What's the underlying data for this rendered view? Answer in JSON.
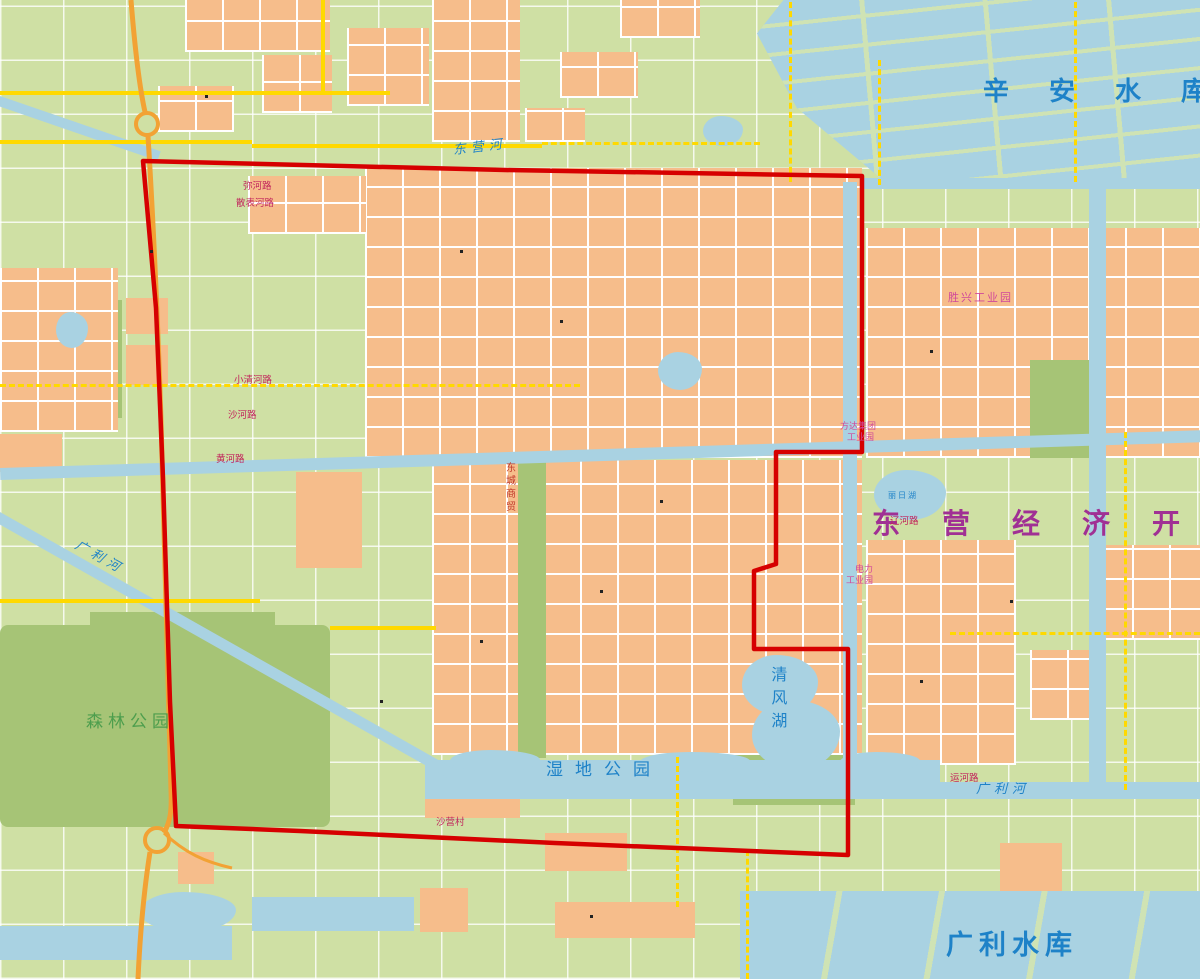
{
  "map": {
    "palette": {
      "land": "#cfe0a4",
      "park_green": "#a6c476",
      "water_blue": "#a9d2e2",
      "urban_orange": "#f6bd8b",
      "road_yellow": "#ffd900",
      "expressway_orange": "#f2a234",
      "boundary_red": "#d60000",
      "water_text": "#1e82c8",
      "city_text": "#a03094",
      "road_text": "#c2255c",
      "park_text": "#4d9e4d"
    },
    "labels": [
      {
        "name": "xinan-reservoir-label",
        "text": "辛安水库",
        "x": 983,
        "y": 78,
        "cls": "lbl-water-lg"
      },
      {
        "name": "guangli-reservoir-label",
        "text": "广利水库",
        "x": 946,
        "y": 930,
        "cls": "lbl-water-res"
      },
      {
        "name": "dev-zone-label",
        "text": "东营经济开",
        "x": 872,
        "y": 508,
        "cls": "lbl-city"
      },
      {
        "name": "forest-park-label",
        "text": "森林公园",
        "x": 86,
        "y": 713,
        "cls": "lbl-park"
      },
      {
        "name": "wetland-park-label",
        "text": "湿地公园",
        "x": 546,
        "y": 761,
        "cls": "lbl-wetland"
      },
      {
        "name": "qingfeng-lake-label",
        "text": "清风湖",
        "x": 768,
        "y": 666,
        "cls": "lbl-lake-v"
      },
      {
        "name": "liri-lake-label",
        "text": "丽日湖",
        "x": 888,
        "y": 491,
        "cls": "lbl-lake-sm"
      },
      {
        "name": "guangli-river-west-label",
        "text": "广利河",
        "x": 72,
        "y": 551,
        "cls": "lbl-river",
        "rot": 29
      },
      {
        "name": "guangli-river-east-label",
        "text": "广利河",
        "x": 976,
        "y": 783,
        "cls": "lbl-river"
      },
      {
        "name": "dongying-river-label",
        "text": "东营河",
        "x": 453,
        "y": 141,
        "cls": "lbl-river",
        "rot": -7
      },
      {
        "name": "xiaoqinghe-road-label",
        "text": "小清河路",
        "x": 234,
        "y": 376,
        "cls": "lbl-road"
      },
      {
        "name": "shahe-road-label",
        "text": "沙河路",
        "x": 228,
        "y": 411,
        "cls": "lbl-road"
      },
      {
        "name": "huanghe-road-label",
        "text": "黄河路",
        "x": 216,
        "y": 455,
        "cls": "lbl-road"
      },
      {
        "name": "mihe-road-label",
        "text": "弥河路",
        "x": 243,
        "y": 182,
        "cls": "lbl-road"
      },
      {
        "name": "sanbiao-road-label",
        "text": "散表河路",
        "x": 236,
        "y": 199,
        "cls": "lbl-road"
      },
      {
        "name": "shengxing-industrial-label",
        "text": "胜兴工业园",
        "x": 948,
        "y": 292,
        "cls": "lbl-ind"
      },
      {
        "name": "fangda-industrial-label-1",
        "text": "方达集团",
        "x": 840,
        "y": 422,
        "cls": "lbl-ind-sm"
      },
      {
        "name": "fangda-industrial-label-2",
        "text": "工业园",
        "x": 847,
        "y": 433,
        "cls": "lbl-ind-sm"
      },
      {
        "name": "power-industrial-label-1",
        "text": "电力",
        "x": 855,
        "y": 565,
        "cls": "lbl-ind-sm"
      },
      {
        "name": "power-industrial-label-2",
        "text": "工业园",
        "x": 846,
        "y": 576,
        "cls": "lbl-ind-sm"
      },
      {
        "name": "dongcheng-trade-label",
        "text": "东城商贸",
        "x": 503,
        "y": 462,
        "cls": "lbl-red-v"
      },
      {
        "name": "yunhe-road-label",
        "text": "运河路",
        "x": 950,
        "y": 774,
        "cls": "lbl-road"
      },
      {
        "name": "shaying-village-label",
        "text": "沙营村",
        "x": 436,
        "y": 818,
        "cls": "lbl-road"
      },
      {
        "name": "liaohe-road-label",
        "text": "辽河路",
        "x": 890,
        "y": 517,
        "cls": "lbl-road"
      }
    ]
  }
}
